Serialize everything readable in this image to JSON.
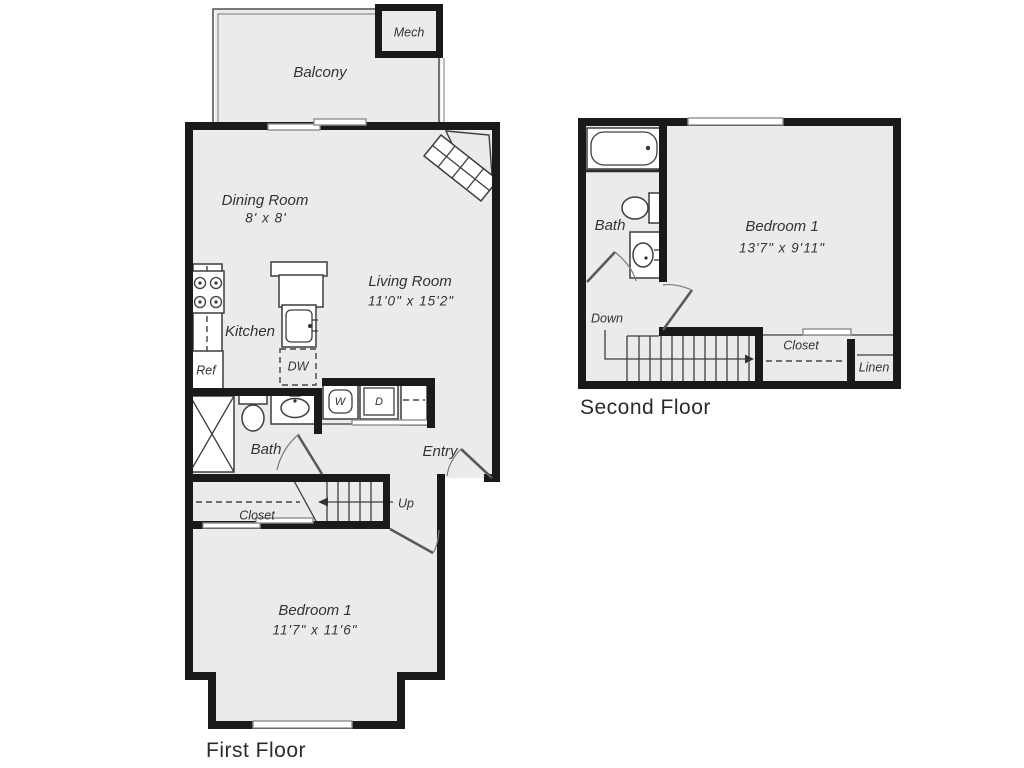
{
  "first_floor": {
    "title": "First Floor",
    "labels": {
      "balcony": "Balcony",
      "mech": "Mech",
      "dining": "Dining Room",
      "dining_dims": "8' x 8'",
      "living": "Living Room",
      "living_dims": "11'0\" x 15'2\"",
      "kitchen": "Kitchen",
      "ref": "Ref",
      "dw": "DW",
      "bath": "Bath",
      "washer": "W",
      "dryer": "D",
      "entry": "Entry",
      "closet": "Closet",
      "up": "Up",
      "bedroom": "Bedroom 1",
      "bedroom_dims": "11'7\" x 11'6\""
    }
  },
  "second_floor": {
    "title": "Second Floor",
    "labels": {
      "bath": "Bath",
      "bedroom": "Bedroom 1",
      "bedroom_dims": "13'7\" x 9'11\"",
      "down": "Down",
      "closet": "Closet",
      "linen": "Linen"
    }
  },
  "colors": {
    "wall": "#1a1a1a",
    "floor": "#ebebeb",
    "fixture": "#3d3d3d",
    "window": "#8f8f8f",
    "text": "#333333"
  }
}
